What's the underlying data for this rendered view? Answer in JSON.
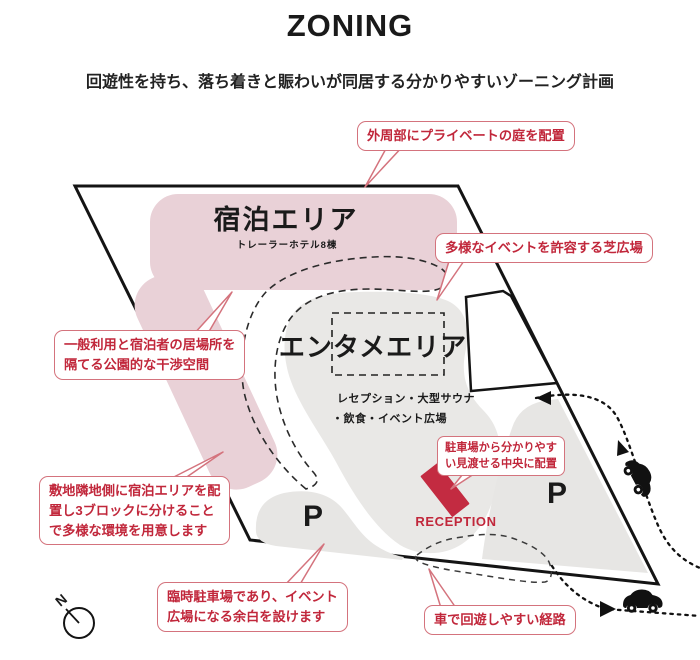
{
  "header": {
    "title": "ZONING",
    "subtitle": "回遊性を持ち、落ち着きと賑わいが同居する分かりやすいゾーニング計画"
  },
  "zones": {
    "accommodation": {
      "name": "宿泊エリア",
      "detail": "トレーラーホテル8棟"
    },
    "entertainment": {
      "name": "エンタメエリア",
      "detail_line1": "レセプション・大型サウナ",
      "detail_line2": "・飲食・イベント広場"
    },
    "parking_left": {
      "name": "P"
    },
    "parking_right": {
      "name": "P"
    },
    "reception": {
      "name": "RECEPTION"
    }
  },
  "annotations": [
    {
      "id": "private-garden",
      "text": "外周部にプライベートの庭を配置"
    },
    {
      "id": "lawn-plaza",
      "text": "多様なイベントを許容する芝広場"
    },
    {
      "id": "buffer-space",
      "text": "一般利用と宿泊者の居場所を\n隔てる公園的な干渉空間"
    },
    {
      "id": "site-blocks",
      "text": "敷地隣地側に宿泊エリアを配\n置し3ブロックに分けること\nで多様な環境を用意します"
    },
    {
      "id": "reception-placement",
      "text": "駐車場から分かりやす\nい見渡せる中央に配置"
    },
    {
      "id": "temp-parking",
      "text": "臨時駐車場であり、イベント\n広場になる余白を設けます"
    },
    {
      "id": "car-route",
      "text": "車で回遊しやすい経路"
    }
  ],
  "compass": {
    "label": "N"
  },
  "colors": {
    "accent_red": "#c1273b",
    "bubble_border": "#d4737d",
    "accommodation_pink": "#e9d1d7",
    "zone_gray": "#e9e8e6",
    "parking_gray": "#e7e6e4",
    "reception_red": "#c32b41"
  }
}
